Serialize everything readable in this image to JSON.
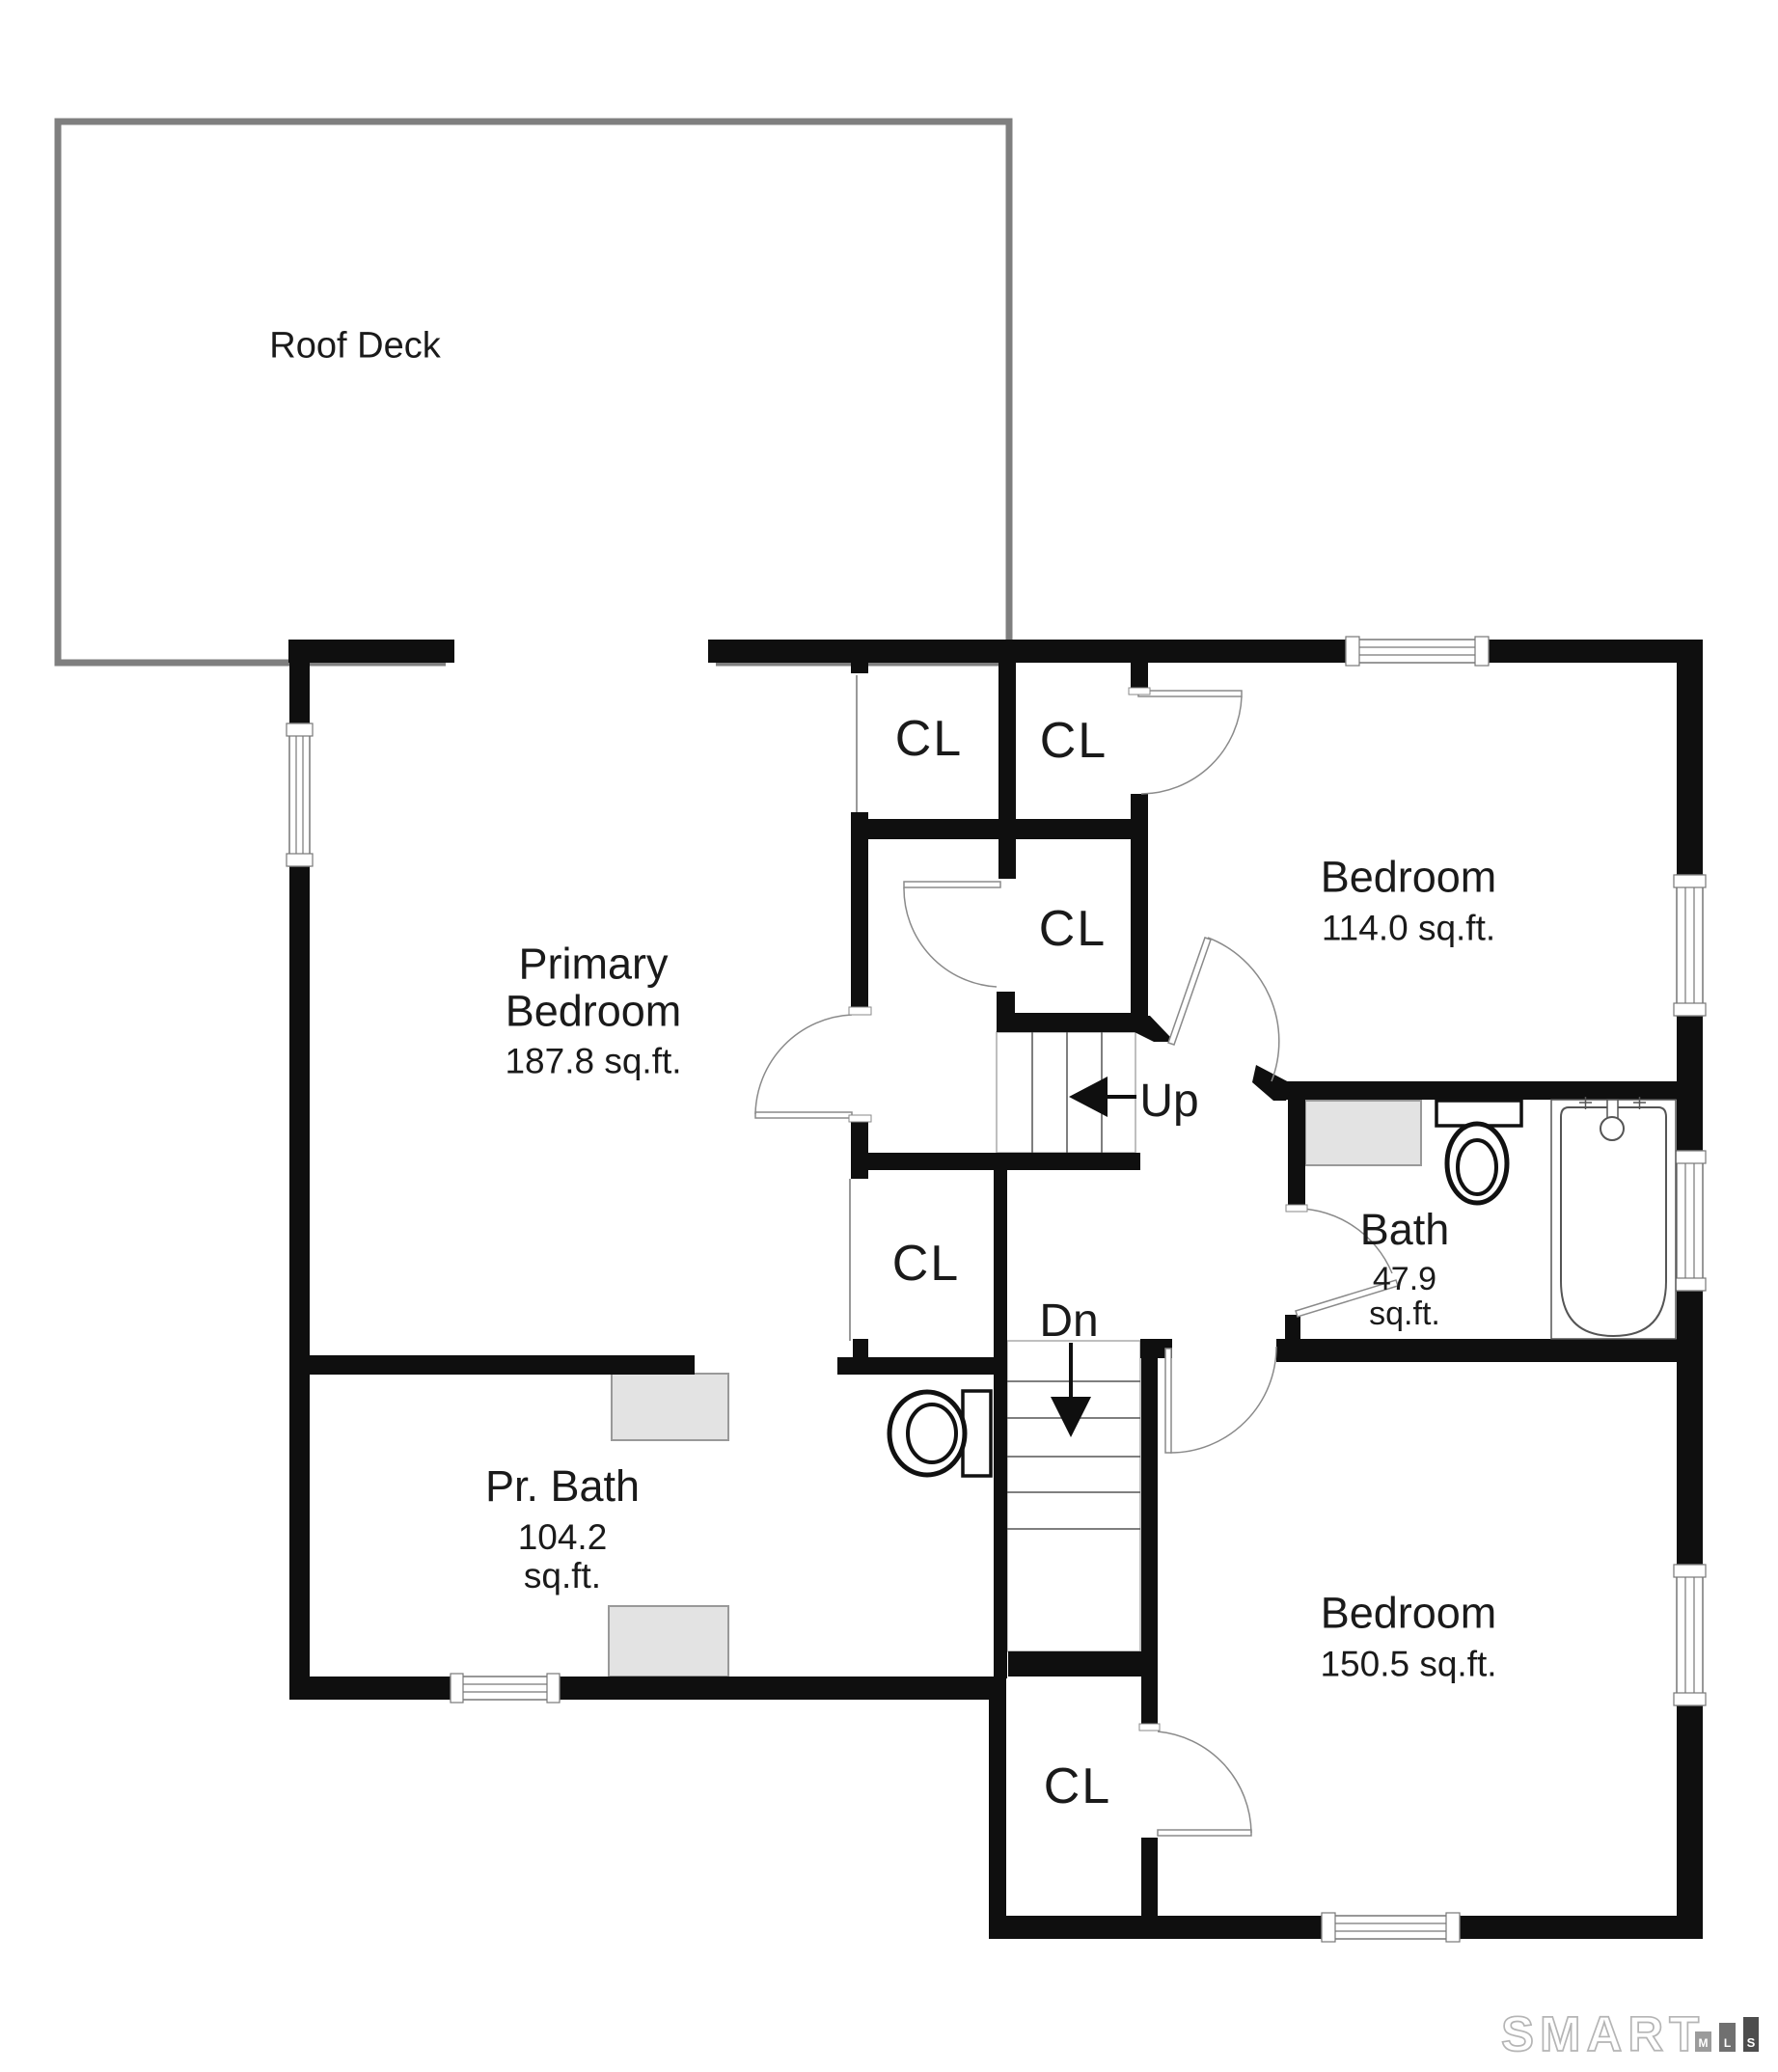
{
  "rooms": {
    "roof_deck": {
      "label": "Roof Deck"
    },
    "primary_bedroom": {
      "name_line1": "Primary",
      "name_line2": "Bedroom",
      "area": "187.8 sq.ft."
    },
    "bedroom_upper_right": {
      "name": "Bedroom",
      "area": "114.0 sq.ft."
    },
    "bath": {
      "name": "Bath",
      "area_value": "47.9",
      "area_unit": "sq.ft."
    },
    "primary_bath": {
      "name": "Pr. Bath",
      "area_value": "104.2",
      "area_unit": "sq.ft."
    },
    "bedroom_lower_right": {
      "name": "Bedroom",
      "area": "150.5 sq.ft."
    }
  },
  "closets": [
    "CL",
    "CL",
    "CL",
    "CL",
    "CL"
  ],
  "stairs": {
    "up_label": "Up",
    "down_label": "Dn"
  },
  "logo": {
    "brand": "SMART",
    "bars": [
      "M",
      "L",
      "S"
    ]
  },
  "colors": {
    "wall": "#0f0f0f",
    "deck_border": "#7f7f7f",
    "fixture_fill": "#e3e3e3",
    "door_line": "#8a8a8a",
    "logo_outline": "#b5b5b5",
    "logo_bar_m": "#9b9b9b",
    "logo_bar_l": "#707070",
    "logo_bar_s": "#4d4d4d"
  }
}
